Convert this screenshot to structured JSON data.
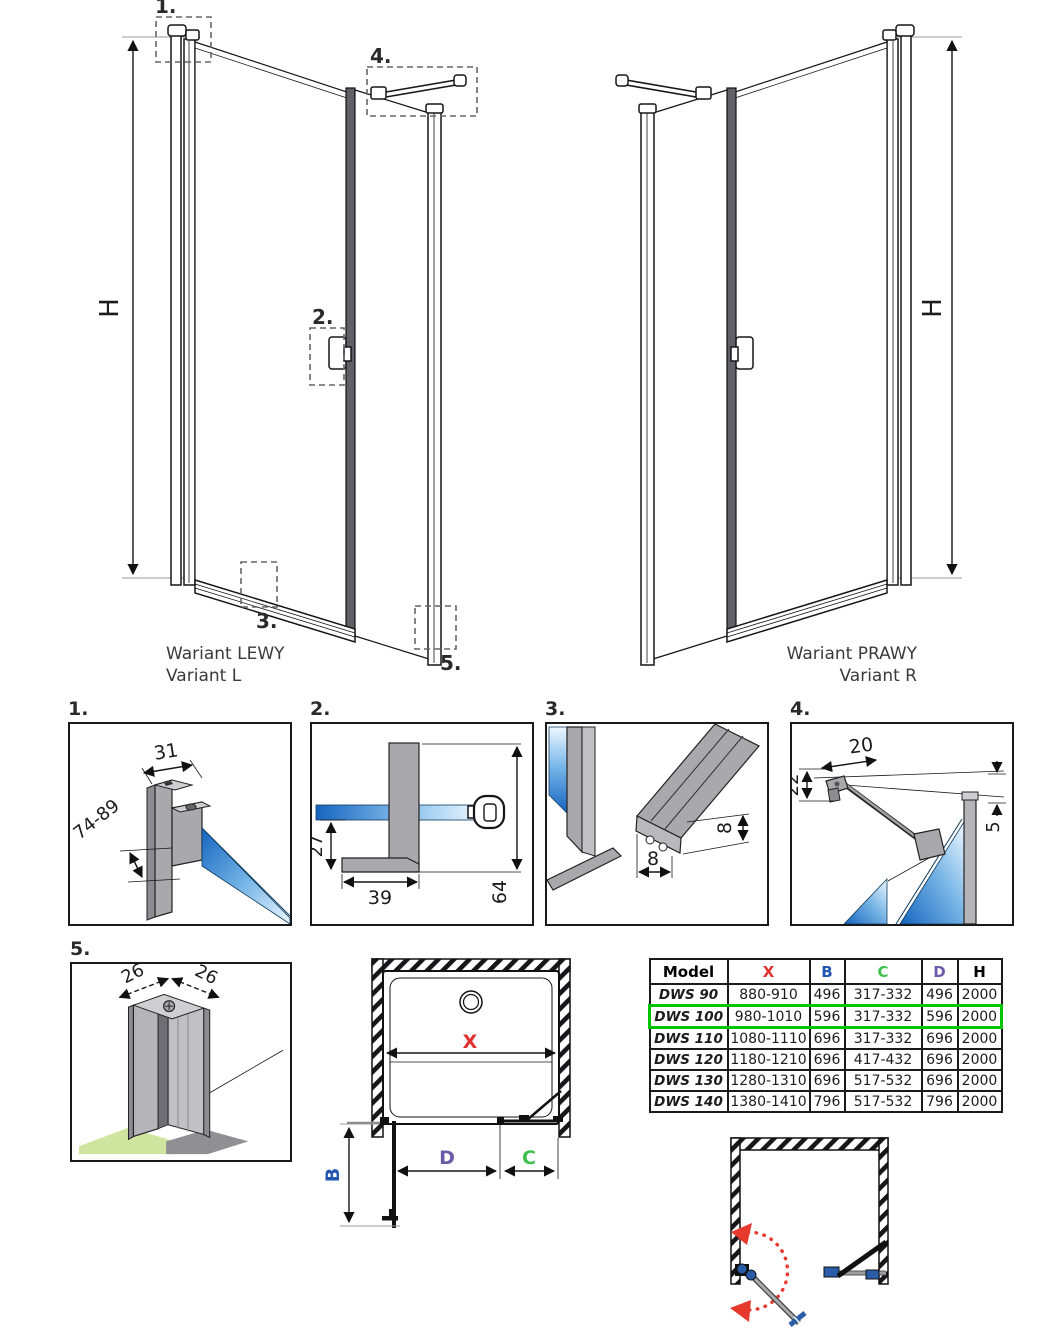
{
  "variants": {
    "left": {
      "label_pl": "Wariant LEWY",
      "label_en": "Variant L",
      "height_dim": "H",
      "callouts": {
        "c1": "1.",
        "c2": "2.",
        "c3": "3.",
        "c4": "4.",
        "c5": "5."
      }
    },
    "right": {
      "label_pl": "Wariant PRAWY",
      "label_en": "Variant R",
      "height_dim": "H"
    }
  },
  "details": {
    "d1": {
      "label": "1.",
      "dim_width": "31",
      "dim_range": "74-89"
    },
    "d2": {
      "label": "2.",
      "dim_front": "27",
      "dim_foot": "39",
      "dim_height": "64"
    },
    "d3": {
      "label": "3.",
      "dim_height": "8",
      "dim_width": "8"
    },
    "d4": {
      "label": "4.",
      "dim_bar": "20",
      "dim_left": "22",
      "dim_right": "5"
    },
    "d5": {
      "label": "5.",
      "dim_left": "26",
      "dim_right": "26"
    }
  },
  "plan": {
    "dim_x": "X",
    "dim_b": "B",
    "dim_c": "C",
    "dim_d": "D"
  },
  "table": {
    "headers": {
      "model": "Model",
      "x": "X",
      "b": "B",
      "c": "C",
      "d": "D",
      "h": "H"
    },
    "rows": [
      {
        "model": "DWS 90",
        "x": "880-910",
        "b": "496",
        "c": "317-332",
        "d": "496",
        "h": "2000"
      },
      {
        "model": "DWS 100",
        "x": "980-1010",
        "b": "596",
        "c": "317-332",
        "d": "596",
        "h": "2000"
      },
      {
        "model": "DWS 110",
        "x": "1080-1110",
        "b": "696",
        "c": "317-332",
        "d": "696",
        "h": "2000"
      },
      {
        "model": "DWS 120",
        "x": "1180-1210",
        "b": "696",
        "c": "417-432",
        "d": "696",
        "h": "2000"
      },
      {
        "model": "DWS 130",
        "x": "1280-1310",
        "b": "696",
        "c": "517-532",
        "d": "696",
        "h": "2000"
      },
      {
        "model": "DWS 140",
        "x": "1380-1410",
        "b": "796",
        "c": "517-532",
        "d": "796",
        "h": "2000"
      }
    ],
    "highlighted_model": "DWS 100"
  },
  "colors": {
    "dim_x_red": "#e0312f",
    "dim_b_blue": "#2356b0",
    "dim_c_green": "#3fbf4e",
    "dim_d_purple": "#6c59a8",
    "highlight_row_border": "#00c400",
    "glass_blue": "#1565c0",
    "profile_gray": "#a8a8ad",
    "floor_green": "#cfe49e",
    "swing_arrow_red": "#e8392f",
    "hinge_blue": "#2a5ca8"
  }
}
